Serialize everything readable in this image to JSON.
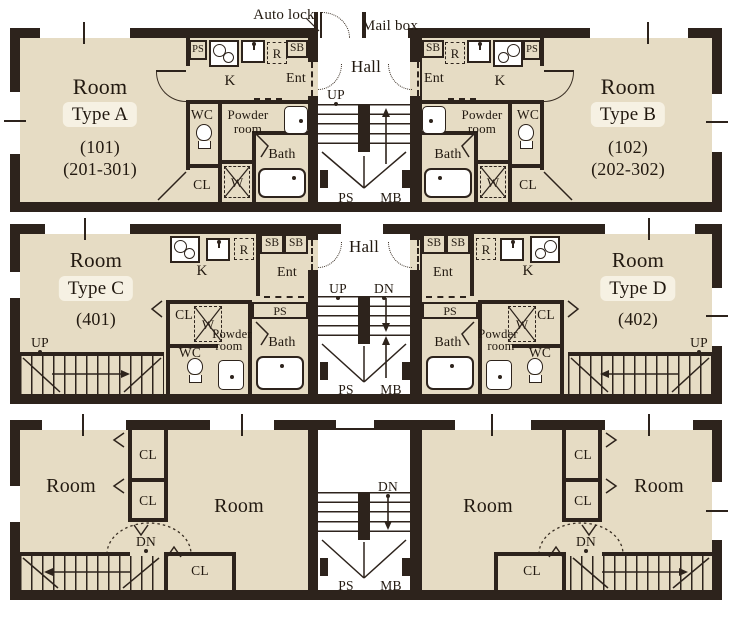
{
  "annotations": {
    "auto_lock": "Auto lock",
    "mail_box": "Mail box"
  },
  "labels": {
    "room": "Room",
    "hall": "Hall",
    "k": "K",
    "ent": "Ent",
    "wc": "WC",
    "bath": "Bath",
    "cl": "CL",
    "w": "W",
    "r": "R",
    "sb": "SB",
    "ps": "PS",
    "mb": "MB",
    "up": "UP",
    "dn": "DN",
    "powder_1": "Powder",
    "powder_2": "room"
  },
  "units": {
    "a": {
      "type": "Type A",
      "number": "(101)",
      "stack": "(201-301)"
    },
    "b": {
      "type": "Type B",
      "number": "(102)",
      "stack": "(202-302)"
    },
    "c": {
      "type": "Type C",
      "number": "(401)"
    },
    "d": {
      "type": "Type D",
      "number": "(402)"
    }
  },
  "colors": {
    "wall": "#2d231c",
    "floor": "#e6dcc4",
    "highlight": "#f6f1e3"
  }
}
